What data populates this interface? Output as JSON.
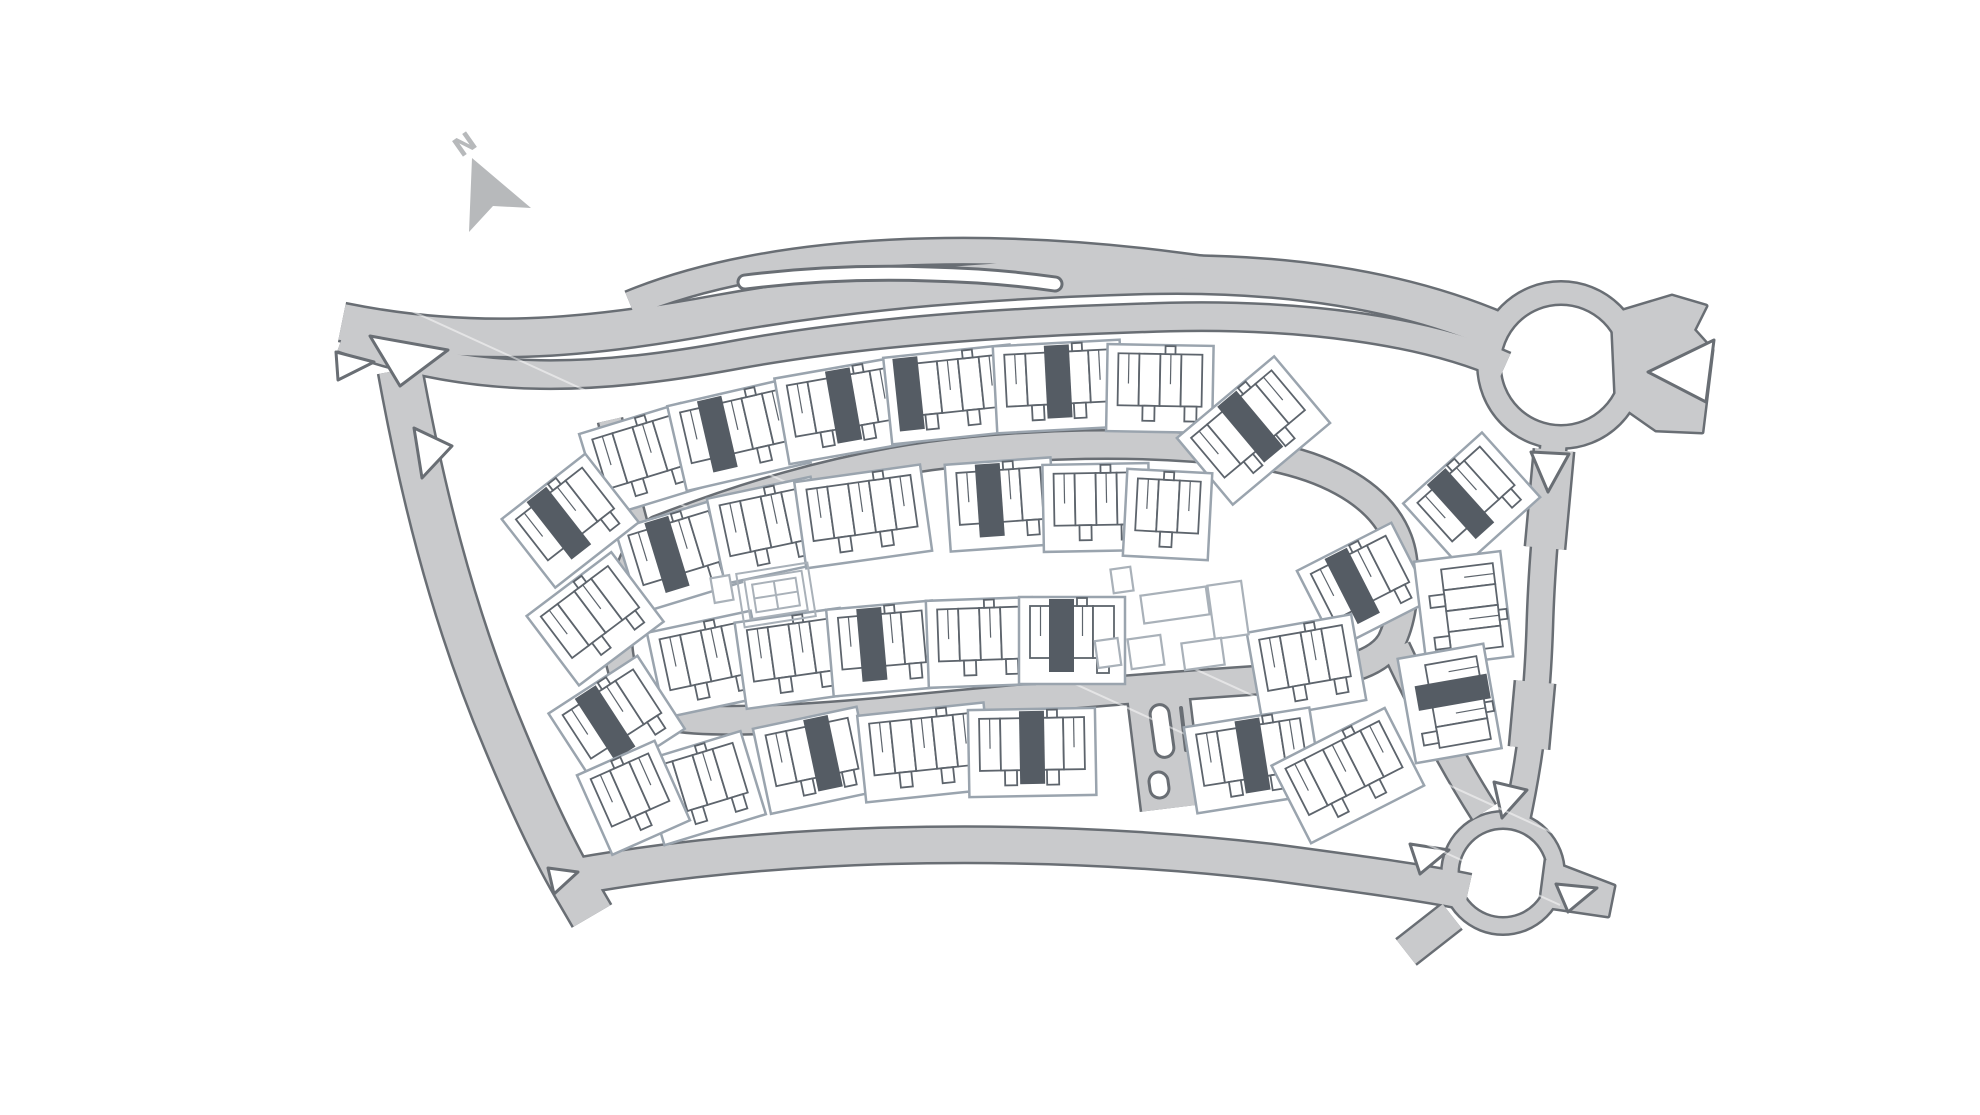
{
  "meta": {
    "type": "housing-development-site-plan"
  },
  "compass": {
    "label": "N",
    "label_x": 461,
    "label_y": 158,
    "label_rot": -35,
    "arrow_points": "472,158 531,208 493,206 469,232",
    "color": "#b7b9bb",
    "label_size": 26
  },
  "colors": {
    "background": "#ffffff",
    "road_fill": "#c9cacc",
    "road_casing": "#696e74",
    "parcel_stroke": "#9aa4ae",
    "unit_stroke": "#5d646c",
    "dark_unit_fill": "#555c64",
    "amenity_stroke": "#a9b1b9",
    "white": "#ffffff"
  },
  "roads": [
    {
      "name": "main-road-north-carriageway",
      "d": "M 342 322 C 470 348 580 340 720 314 C 860 289 1000 279 1140 275 C 1280 271 1400 289 1500 332",
      "w": 36
    },
    {
      "name": "main-road-south-carriageway",
      "d": "M 342 338 C 480 388 600 380 740 354 C 880 329 1030 321 1170 317 C 1300 314 1425 330 1505 366",
      "w": 26
    },
    {
      "name": "bypass-lane",
      "d": "M 630 304 C 700 275 790 258 890 253 C 990 248 1090 254 1180 266 C 1250 275 1320 286 1382 300",
      "w": 24
    },
    {
      "name": "west-road",
      "d": "M 400 370 C 420 480 450 610 505 740 C 530 800 554 852 578 892 L 592 916",
      "w": 42
    },
    {
      "name": "south-road",
      "d": "M 556 880 C 650 862 760 850 880 846 C 1020 842 1150 848 1270 862 C 1360 874 1432 884 1468 892",
      "w": 34
    },
    {
      "name": "east-road",
      "d": "M 1554 440 C 1548 500 1542 560 1540 620 C 1538 690 1532 750 1516 824",
      "w": 24
    },
    {
      "name": "east-road-widening-upper",
      "d": "M 1554 450 L 1545 548",
      "w": 38
    },
    {
      "name": "east-road-widening-lower",
      "d": "M 1535 682 L 1529 748",
      "w": 38
    },
    {
      "name": "loop-street",
      "d": "M 658 530 C 740 498 830 470 930 456 C 1030 443 1140 440 1240 452 C 1320 461 1380 492 1398 540 C 1408 566 1405 612 1392 640 C 1378 668 1330 676 1260 680 C 1140 688 1000 700 880 712 C 790 720 710 724 668 716 C 636 709 620 680 618 644 C 616 606 630 548 658 530 Z",
      "w": 26
    },
    {
      "name": "loop-entry-street",
      "d": "M 610 420 C 618 455 626 490 636 526",
      "w": 22
    },
    {
      "name": "loop-southeast-link",
      "d": "M 1396 648 C 1420 700 1452 762 1484 812",
      "w": 26
    },
    {
      "name": "south-link-street",
      "d": "M 1158 694 L 1172 808",
      "w": 60
    },
    {
      "name": "roundabout-southwest-exit",
      "d": "M 1452 916 L 1406 952",
      "w": 30
    }
  ],
  "patches": [
    {
      "name": "east-flare",
      "points": "1612,314 1672,296 1706,306 1694,330 1712,350 1702,432 1656,430 1616,402"
    },
    {
      "name": "southeast-stub",
      "points": "1546,860 1614,886 1608,916 1540,906"
    }
  ],
  "roundabouts": [
    {
      "name": "roundabout-north-east",
      "cx": 1561,
      "cy": 365,
      "r": 72,
      "w": 21
    },
    {
      "name": "roundabout-south-east",
      "cx": 1503,
      "cy": 873,
      "r": 53,
      "w": 15
    }
  ],
  "lane_island": {
    "d": "M 745 282 C 810 274 870 272 930 274 C 975 275 1020 279 1055 284",
    "casing_w": 17,
    "w": 11
  },
  "islands": [
    {
      "name": "junction-island",
      "points": "370,336 448,350 400,386"
    },
    {
      "name": "junction-island",
      "points": "336,352 374,362 338,380"
    },
    {
      "name": "junction-island",
      "points": "414,428 452,446 422,478"
    },
    {
      "name": "junction-island",
      "points": "548,868 578,872 554,894"
    },
    {
      "name": "junction-island",
      "points": "1531,452 1569,454 1548,492"
    },
    {
      "name": "junction-island",
      "points": "1714,340 1648,372 1706,402"
    },
    {
      "name": "junction-island",
      "points": "1494,782 1527,790 1502,818"
    },
    {
      "name": "junction-island",
      "points": "1410,844 1449,850 1420,874"
    },
    {
      "name": "junction-island",
      "points": "1556,884 1597,888 1568,912"
    }
  ],
  "stadium_islands": [
    {
      "x": 1162,
      "y": 731,
      "w": 19,
      "h": 53,
      "rot": -8
    },
    {
      "x": 1159,
      "y": 785,
      "w": 19,
      "h": 26,
      "rot": -8
    }
  ],
  "hedge_lines": [
    {
      "x1": 1181,
      "y1": 708,
      "x2": 1186,
      "y2": 750
    }
  ],
  "artifact_lines": [
    {
      "x1": 300,
      "y1": 260,
      "x2": 1700,
      "y2": 900
    },
    {
      "x1": 430,
      "y1": 390,
      "x2": 1560,
      "y2": 905
    }
  ],
  "court": {
    "x": 776,
    "y": 595,
    "w": 72,
    "h": 54,
    "rot": -9
  },
  "buildings": [
    {
      "x": 1122,
      "y": 580,
      "w": 20,
      "h": 24,
      "rot": -8
    },
    {
      "x": 1175,
      "y": 605,
      "w": 66,
      "h": 28,
      "rot": -8
    },
    {
      "x": 1228,
      "y": 610,
      "w": 34,
      "h": 54,
      "rot": -8
    },
    {
      "x": 1146,
      "y": 652,
      "w": 33,
      "h": 30,
      "rot": -8
    },
    {
      "x": 1203,
      "y": 654,
      "w": 40,
      "h": 27,
      "rot": -8
    },
    {
      "x": 1108,
      "y": 653,
      "w": 23,
      "h": 27,
      "rot": -8
    },
    {
      "x": 722,
      "y": 589,
      "w": 19,
      "h": 25,
      "rot": -10
    }
  ],
  "blocks": [
    {
      "x": 640,
      "y": 452,
      "r": -17,
      "n": 4,
      "d": -1
    },
    {
      "x": 737,
      "y": 426,
      "r": -13,
      "n": 5,
      "d": 1
    },
    {
      "x": 843,
      "y": 402,
      "r": -10,
      "n": 5,
      "d": 2
    },
    {
      "x": 950,
      "y": 386,
      "r": -6,
      "n": 5,
      "d": 0
    },
    {
      "x": 1058,
      "y": 378,
      "r": -3,
      "n": 5,
      "d": 2
    },
    {
      "x": 1160,
      "y": 380,
      "r": 1,
      "n": 4,
      "d": -1
    },
    {
      "x": 1248,
      "y": 424,
      "r": -40,
      "n": 5,
      "d": 2
    },
    {
      "x": 676,
      "y": 548,
      "r": -17,
      "n": 4,
      "d": 1
    },
    {
      "x": 766,
      "y": 522,
      "r": -12,
      "n": 4,
      "d": -1
    },
    {
      "x": 862,
      "y": 508,
      "r": -8,
      "n": 5,
      "d": -1
    },
    {
      "x": 1000,
      "y": 496,
      "r": -4,
      "n": 4,
      "d": 1
    },
    {
      "x": 1096,
      "y": 499,
      "r": -1,
      "n": 4,
      "d": -1
    },
    {
      "x": 1168,
      "y": 506,
      "r": 3,
      "n": 3,
      "d": -1
    },
    {
      "x": 706,
      "y": 656,
      "r": -12,
      "n": 4,
      "d": -1
    },
    {
      "x": 792,
      "y": 650,
      "r": -8,
      "n": 4,
      "d": -1
    },
    {
      "x": 882,
      "y": 640,
      "r": -5,
      "n": 4,
      "d": 1
    },
    {
      "x": 980,
      "y": 634,
      "r": -2,
      "n": 4,
      "d": -1
    },
    {
      "x": 1072,
      "y": 632,
      "r": 0,
      "n": 4,
      "d": 1
    },
    {
      "x": 1360,
      "y": 578,
      "r": -27,
      "n": 4,
      "d": 1
    },
    {
      "x": 1305,
      "y": 658,
      "r": -10,
      "n": 4,
      "d": -1
    },
    {
      "x": 700,
      "y": 780,
      "r": -17,
      "n": 4,
      "d": -1
    },
    {
      "x": 812,
      "y": 752,
      "r": -12,
      "n": 4,
      "d": 2
    },
    {
      "x": 924,
      "y": 744,
      "r": -6,
      "n": 5,
      "d": -1
    },
    {
      "x": 1032,
      "y": 744,
      "r": -1,
      "n": 5,
      "d": 2
    },
    {
      "x": 1252,
      "y": 752,
      "r": -9,
      "n": 5,
      "d": 2
    },
    {
      "x": 1344,
      "y": 768,
      "r": -27,
      "n": 5,
      "d": -1
    },
    {
      "x": 565,
      "y": 514,
      "r": -38,
      "n": 4,
      "d": 1
    },
    {
      "x": 590,
      "y": 612,
      "r": -37,
      "n": 4,
      "d": -1
    },
    {
      "x": 612,
      "y": 714,
      "r": -33,
      "n": 4,
      "d": 1
    },
    {
      "x": 630,
      "y": 790,
      "r": -24,
      "n": 3,
      "d": -1
    },
    {
      "x": 1466,
      "y": 494,
      "r": -42,
      "n": 4,
      "d": 1
    },
    {
      "x": 1472,
      "y": 608,
      "r": 83,
      "n": 4,
      "d": -1
    },
    {
      "x": 1458,
      "y": 702,
      "r": 80,
      "n": 4,
      "d": 1
    }
  ],
  "unit": {
    "w": 21,
    "h": 52,
    "parcel_margin_x": 11,
    "parcel_margin_top": 9,
    "parcel_margin_bottom": 26
  }
}
